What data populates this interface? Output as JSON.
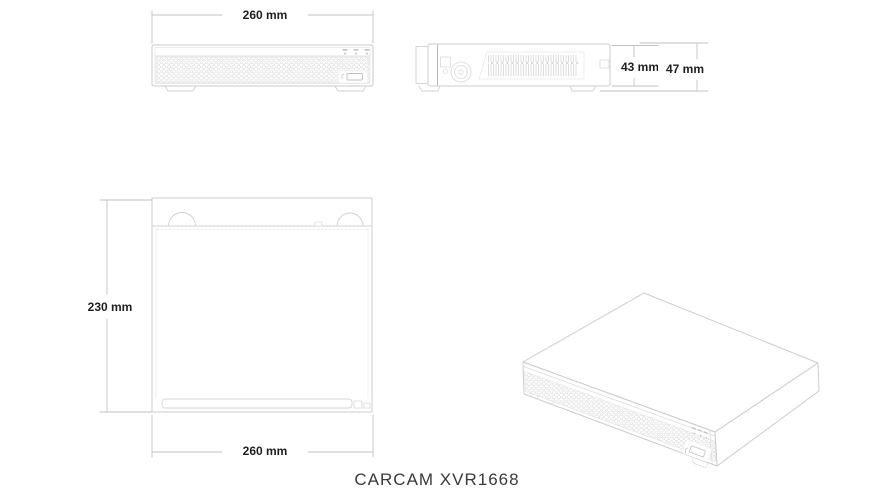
{
  "product": {
    "model": "CARCAM XVR1668"
  },
  "dimensions": {
    "front_width": "260 mm",
    "side_height_body": "43 mm",
    "side_height_total": "47 mm",
    "top_depth": "230 mm",
    "top_width": "260 mm"
  },
  "colors": {
    "outline": "#c9c9c9",
    "detail": "#dcdcdc",
    "dimension_line": "#c2c2c2",
    "label_text": "#1f1f1f",
    "seam_accent": "#c9a3a3",
    "background": "#ffffff"
  }
}
